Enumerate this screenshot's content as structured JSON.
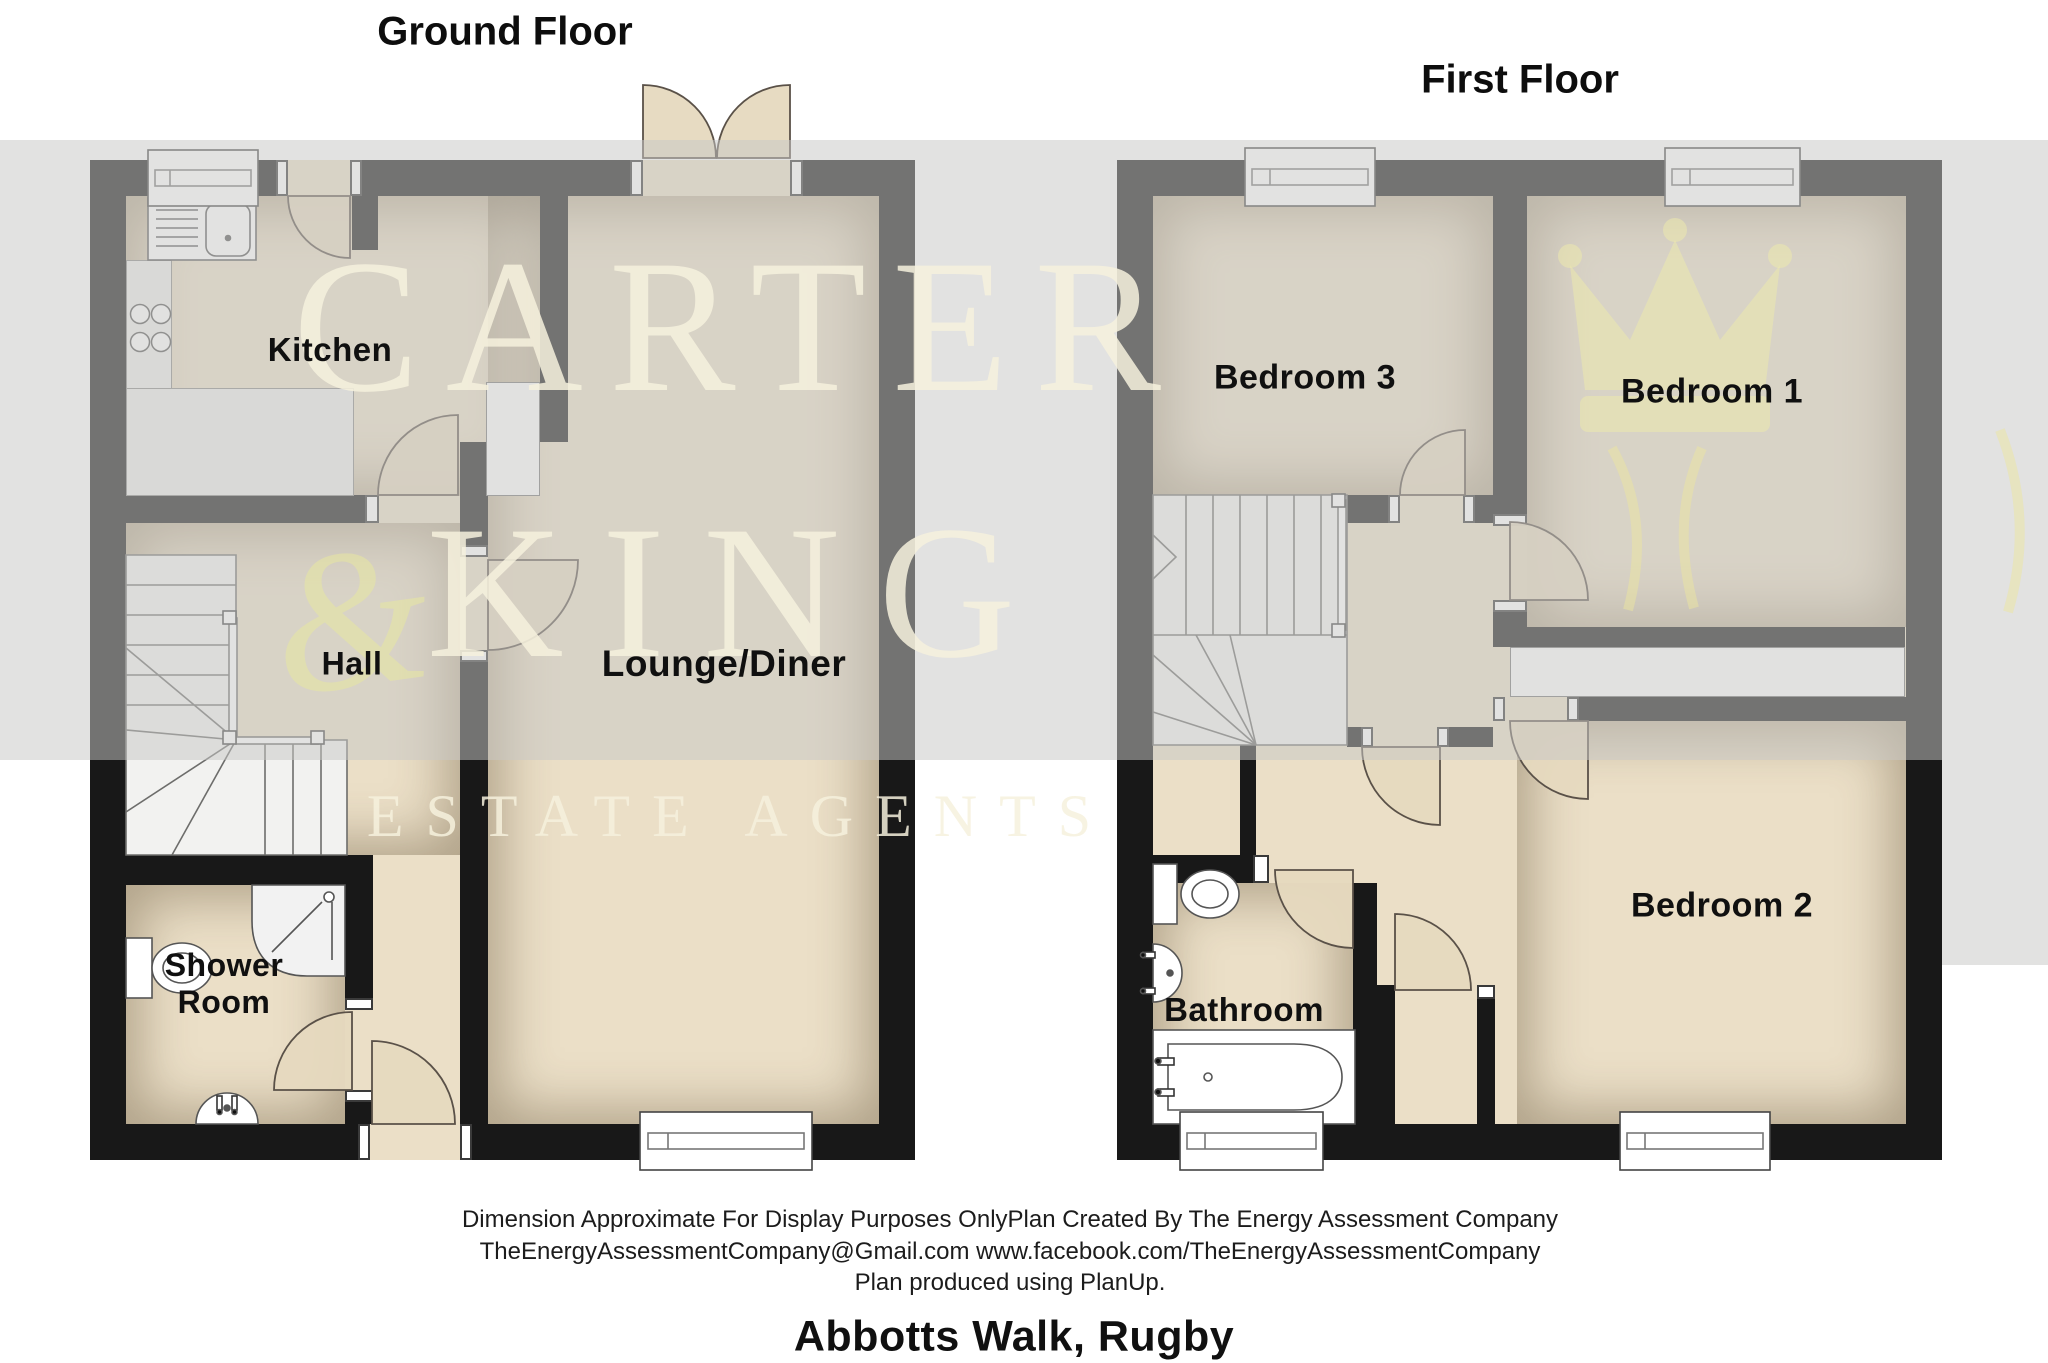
{
  "document": {
    "type": "floor-plan",
    "address": "Abbotts Walk, Rugby"
  },
  "titles": {
    "ground_floor": "Ground Floor",
    "first_floor": "First Floor"
  },
  "ground_floor": {
    "kitchen": "Kitchen",
    "hall": "Hall",
    "shower_room_line1": "Shower",
    "shower_room_line2": "Room",
    "lounge_diner": "Lounge/Diner"
  },
  "first_floor": {
    "bedroom3": "Bedroom 3",
    "bedroom1": "Bedroom 1",
    "bedroom2": "Bedroom 2",
    "bathroom": "Bathroom"
  },
  "footer": {
    "line1": "Dimension Approximate For Display Purposes OnlyPlan Created By The Energy Assessment Company",
    "line2": "TheEnergyAssessmentCompany@Gmail.com www.facebook.com/TheEnergyAssessmentCompany",
    "line3": "Plan produced using PlanUp."
  },
  "watermark": {
    "word1": "CARTER",
    "word2": "KING",
    "word3": "ESTATE AGENTS",
    "ampersand": "&"
  },
  "colors": {
    "wall": "#181818",
    "floor_tan": "#ebdfc7",
    "fixture_light": "#ededeb",
    "watermark_cream": "#f6f1dd",
    "watermark_gray": "#c7c7c5",
    "crown_yellow": "#ede9ad"
  }
}
